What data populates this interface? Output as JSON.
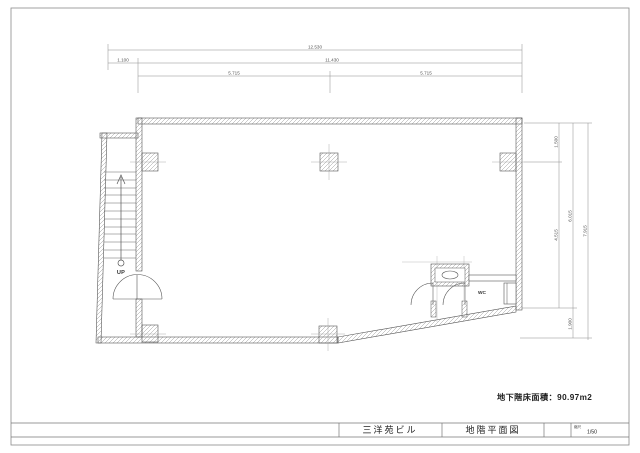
{
  "colors": {
    "ink": "#4a4a4a",
    "dim": "#7a7a7a",
    "hatch": "#9a9a9a",
    "paper": "#ffffff"
  },
  "dimensions": {
    "top": {
      "total": "12.530",
      "row2": [
        "1.100",
        "11.430"
      ],
      "row3": [
        "5.715",
        "5.715"
      ]
    },
    "right": {
      "inner": [
        "1.500",
        "4.515"
      ],
      "middle": [
        "6.015",
        "1.900"
      ],
      "outer": "7.915"
    }
  },
  "plan_labels": {
    "up": "UP",
    "wc": "WC"
  },
  "area_note": "地下階床面積：90.97m2",
  "title_block": {
    "building": "三洋苑ビル",
    "drawing": "地階平面図",
    "scale_label": "縮尺",
    "scale": "1/50"
  }
}
